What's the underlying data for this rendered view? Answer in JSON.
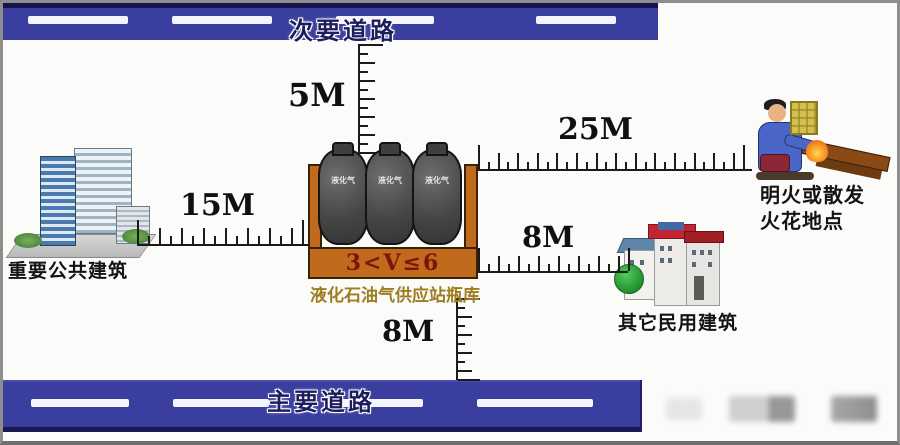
{
  "roads": {
    "secondary": "次要道路",
    "main": "主要道路"
  },
  "distances": {
    "to_secondary_road": "5M",
    "to_public_building": "15M",
    "to_fire_spot": "25M",
    "to_civil_building": "8M",
    "to_main_road": "8M"
  },
  "station": {
    "volume_formula": "3<V≤6",
    "name": "液化石油气供应站瓶库",
    "cylinder_label": "液化气"
  },
  "buildings": {
    "public": "重要公共建筑",
    "civil": "其它民用建筑"
  },
  "fire_spot": {
    "line1": "明火或散发",
    "line2": "火花地点"
  },
  "colors": {
    "road_blue": "#3a3e9f",
    "road_edge_navy": "#14144a",
    "container_orange": "#bf6a1c",
    "formula_red": "#7c140c",
    "station_label_olive": "#9c7d1f",
    "cylinder_gray": "#474747",
    "ruler_black": "#1b1b1b"
  }
}
